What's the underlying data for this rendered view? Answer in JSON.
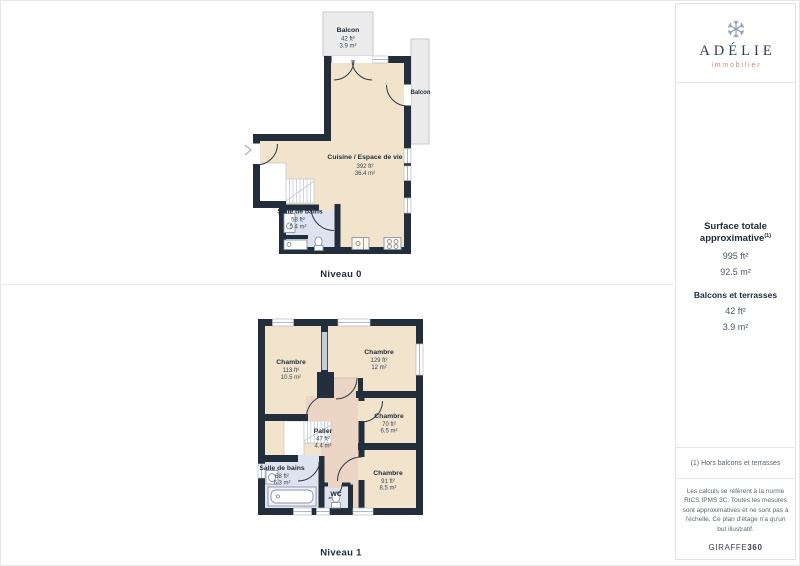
{
  "brand": {
    "name": "ADÉLIE",
    "tagline": "immobilier"
  },
  "levels": [
    {
      "label": "Niveau 0",
      "rooms": [
        {
          "name": "Balcon",
          "ft": "42 ft²",
          "m": "3.9 m²"
        },
        {
          "name": "Balcon"
        },
        {
          "name": "Cuisine / Espace de vie",
          "ft": "392 ft²",
          "m": "36.4 m²"
        },
        {
          "name": "Salle de bains",
          "ft": "58 ft²",
          "m": "5.4 m²"
        }
      ]
    },
    {
      "label": "Niveau 1",
      "rooms": [
        {
          "name": "Chambre",
          "ft": "113 ft²",
          "m": "10.5 m²"
        },
        {
          "name": "Chambre",
          "ft": "129 ft²",
          "m": "12 m²"
        },
        {
          "name": "Chambre",
          "ft": "70 ft²",
          "m": "6.5 m²"
        },
        {
          "name": "Chambre",
          "ft": "91 ft²",
          "m": "8.5 m²"
        },
        {
          "name": "Palier",
          "ft": "47 ft²",
          "m": "4.4 m²"
        },
        {
          "name": "Salle de bains",
          "ft": "68 ft²",
          "m": "6.3 m²"
        },
        {
          "name": "WC"
        }
      ]
    }
  ],
  "sidebar": {
    "surface_title": "Surface totale approximative",
    "surface_sup": "(1)",
    "surface_ft": "995 ft²",
    "surface_m": "92.5 m²",
    "balconies_title": "Balcons et terrasses",
    "balconies_ft": "42 ft²",
    "balconies_m": "3.9 m²",
    "note": "(1) Hors balcons et terrasses",
    "disclaimer": "Les calculs se réfèrent à la norme RICS IPMS 3C. Toutes les mesures sont approximatives et ne sont pas à l'échelle. Ce plan d'étage n'a qu'un but illustratif.",
    "watermark": "GIRAFFE",
    "watermark_bold": "360"
  },
  "colors": {
    "wall": "#232e3d",
    "floor_living": "#f2e4cc",
    "floor_landing": "#ecd5c5",
    "floor_bath": "#dfe3ef",
    "balcony": "#ececec",
    "brand_navy": "#2e3c50",
    "brand_salmon": "#cd8a77"
  }
}
